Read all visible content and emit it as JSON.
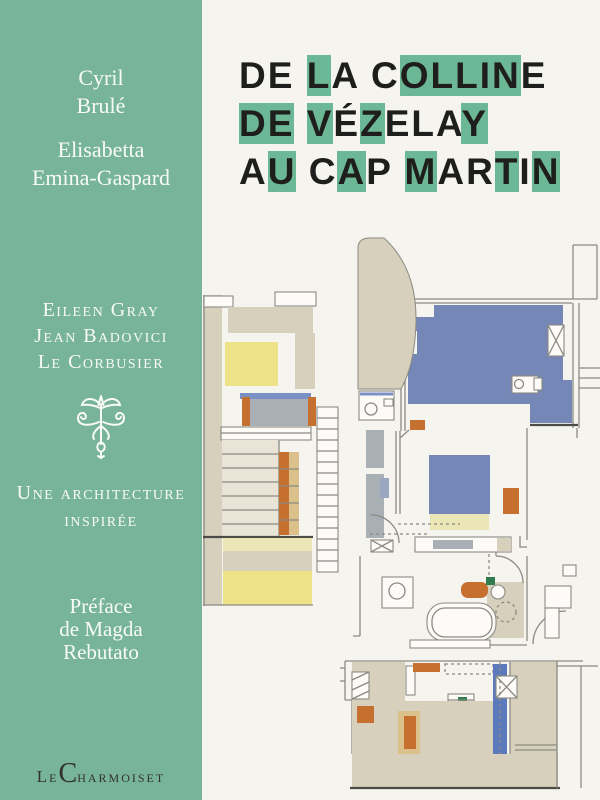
{
  "palette": {
    "green": "#77b49a",
    "titleGreen": "#6cb795",
    "ink": "#1e1e1c",
    "white": "#f8faf7",
    "paper": "#f6f4ee",
    "beige": "#d7d0bd",
    "beigeLight": "#e9e4d6",
    "yellow": "#eee289",
    "paleYellow": "#eae6b5",
    "blue": "#7487b7",
    "blueBright": "#5b79bb",
    "blueEdge": "#7b90c6",
    "grayFurn": "#a9b0b5",
    "grayBlue": "#9aa7c0",
    "orange": "#c6702f",
    "tan": "#dcc08b",
    "greenFix": "#2f7c4e",
    "line": "#8a8a82",
    "dark": "#4c4c47",
    "pub": "#32322c"
  },
  "sidebar": {
    "author1": [
      "Cyril",
      "Brulé"
    ],
    "author2": [
      "Elisabetta",
      "Emina-Gaspard"
    ],
    "subjects": [
      "Eileen Gray",
      "Jean Badovici",
      "Le Corbusier"
    ],
    "tagline": [
      "Une architecture",
      "inspirée"
    ],
    "preface": [
      "Préface",
      "de Magda",
      "Rebutato"
    ],
    "publisher": {
      "prefix": "Le",
      "initial": "C",
      "rest": "harmoiset"
    },
    "ornament_icon": "fleuron-icon"
  },
  "title": {
    "lines": [
      {
        "text": "DE LA COLLINE",
        "green": [
          3,
          7,
          8,
          9,
          10,
          11
        ]
      },
      {
        "text": "DE VÉZELAY",
        "green": [
          0,
          1,
          3,
          5,
          9
        ]
      },
      {
        "text": "AU CAP MARTIN",
        "green": [
          1,
          4,
          7,
          10,
          12
        ]
      }
    ]
  },
  "plan": {
    "illustration": "colored architectural floor plan of a modernist villa"
  }
}
